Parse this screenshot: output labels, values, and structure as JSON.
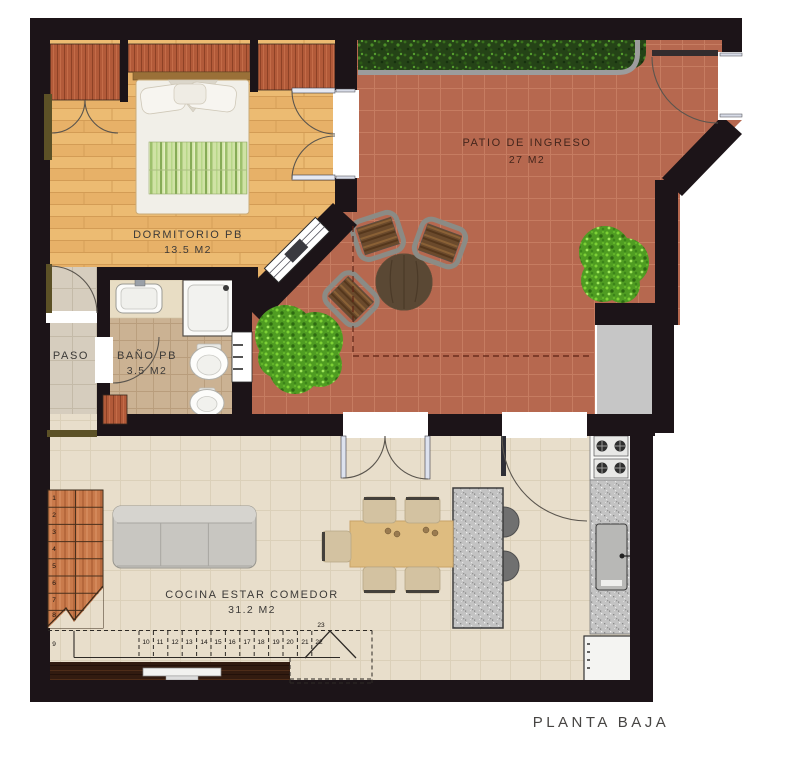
{
  "title": "PLANTA BAJA",
  "rooms": {
    "dormitorio": {
      "name": "DORMITORIO PB",
      "area": "13.5 M2"
    },
    "bano": {
      "name": "BAÑO PB",
      "area": "3.5 M2"
    },
    "paso": {
      "name": "PASO"
    },
    "patio": {
      "name": "PATIO DE INGRESO",
      "area": "27 M2"
    },
    "cocina": {
      "name": "COCINA ESTAR COMEDOR",
      "area": "31.2 M2"
    }
  },
  "stairs": {
    "steps": [
      "1",
      "2",
      "3",
      "4",
      "5",
      "6",
      "7",
      "8",
      "9",
      "10",
      "11",
      "12",
      "13",
      "14",
      "15",
      "16",
      "17",
      "18",
      "19",
      "20",
      "21",
      "22",
      "23"
    ]
  },
  "palette": {
    "wall": "#1c1418",
    "patio_tile": "#b6684f",
    "bedroom_wood": "#ecbb72",
    "kitchen_floor": "#e8decb",
    "bath_tile": "#cbb293",
    "paso_tile": "#d6cdbe",
    "hedge_green": "#254317",
    "closet_wood": "#b25a39",
    "stair_wood": "#c97a4b",
    "island_gray": "#c3c3c3",
    "sofa_gray": "#c8c6c1"
  }
}
